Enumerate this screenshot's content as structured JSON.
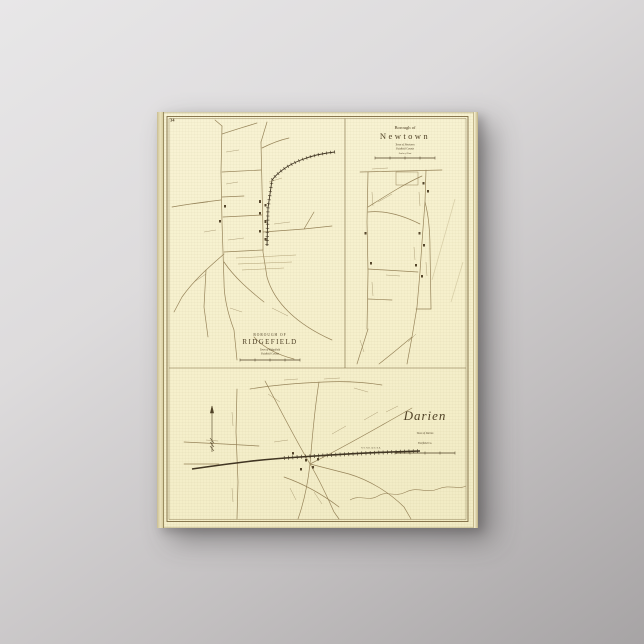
{
  "page": {
    "number": "34"
  },
  "panels": {
    "ridgefield": {
      "title_line1": "BOROUGH OF",
      "title_line2": "RIDGEFIELD",
      "subtitle_line1": "Town of Ridgefield",
      "subtitle_line2": "Fairfield County"
    },
    "newtown": {
      "title_line1": "Borough of",
      "title_line2": "Newtown",
      "subtitle_line1": "Town of Newtown",
      "subtitle_line2": "Fairfield County",
      "scale_label": "Scale of Feet"
    },
    "darien": {
      "title": "Darien",
      "subtitle_line1": "Town of Darien",
      "subtitle_line2": "Fairfield Co.",
      "railroad_label": "N.Y. N.H. & H. R.R."
    }
  },
  "colors": {
    "backdrop_light": "#e8e7e8",
    "backdrop_dark": "#a7a4a5",
    "paper": "#f6f0cc",
    "ink": "#4f4126",
    "road": "#97845a",
    "railroad": "#3f3422"
  }
}
